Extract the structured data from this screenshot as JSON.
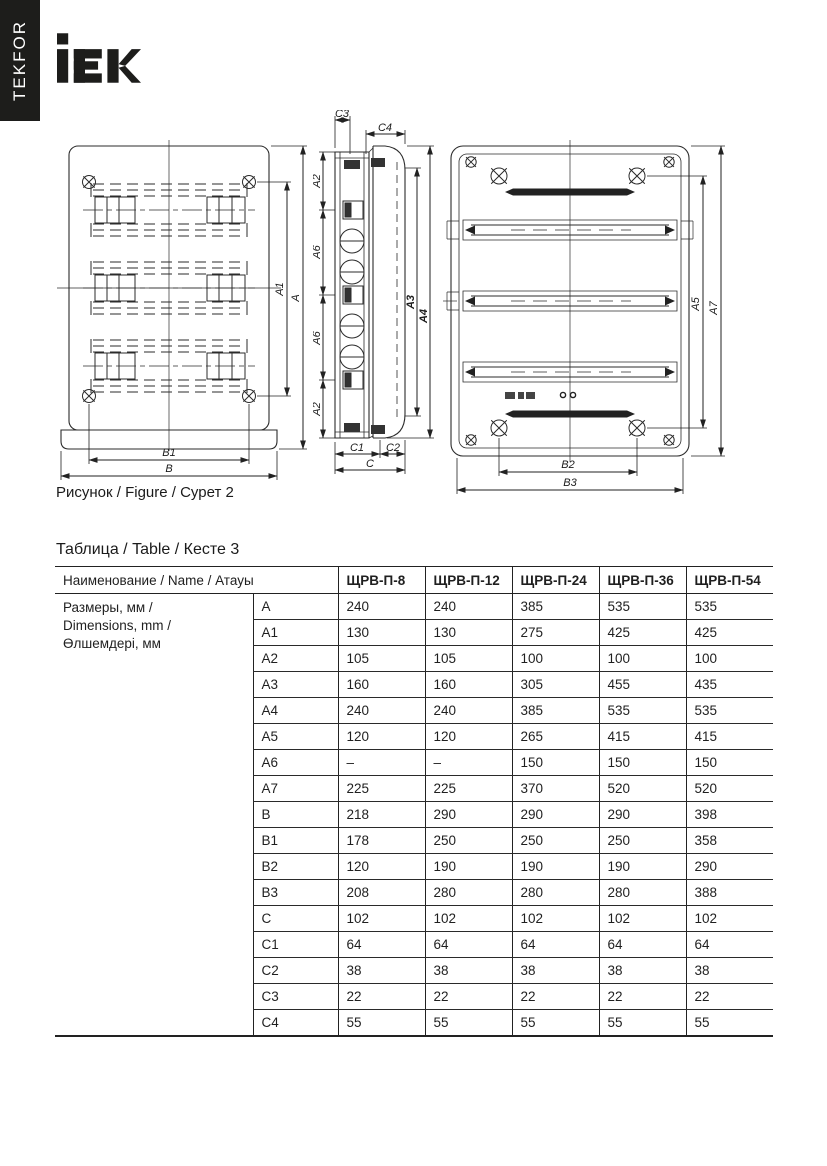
{
  "brand": {
    "vertical_text": "TEKFOR",
    "logo_text": "iEK",
    "brand_color": "#1d1d1b"
  },
  "figure": {
    "caption": "Рисунок / Figure / Сурет 2",
    "front_view": {
      "dim_labels": {
        "a": "A",
        "a1": "A1",
        "b1": "B1",
        "b": "B"
      }
    },
    "side_view": {
      "dim_labels": {
        "c3": "C3",
        "c4": "C4",
        "a2_top": "A2",
        "a6_upper": "A6",
        "a6_lower": "A6",
        "a2_bottom": "A2",
        "a3": "A3",
        "a4": "A4",
        "c1": "C1",
        "c2": "C2",
        "c": "C"
      }
    },
    "back_view": {
      "dim_labels": {
        "a5": "A5",
        "a7": "A7",
        "b2": "B2",
        "b3": "B3"
      }
    }
  },
  "table": {
    "title": "Таблица / Table / Кесте 3",
    "name_header": "Наименование / Name / Атауы",
    "group_label_lines": [
      "Размеры, мм /",
      "Dimensions, mm /",
      "Өлшемдері, мм"
    ],
    "models": [
      "ЩРВ-П-8",
      "ЩРВ-П-12",
      "ЩРВ-П-24",
      "ЩРВ-П-36",
      "ЩРВ-П-54"
    ],
    "rows": [
      {
        "dim": "A",
        "values": [
          "240",
          "240",
          "385",
          "535",
          "535"
        ]
      },
      {
        "dim": "A1",
        "values": [
          "130",
          "130",
          "275",
          "425",
          "425"
        ]
      },
      {
        "dim": "A2",
        "values": [
          "105",
          "105",
          "100",
          "100",
          "100"
        ]
      },
      {
        "dim": "A3",
        "values": [
          "160",
          "160",
          "305",
          "455",
          "435"
        ]
      },
      {
        "dim": "A4",
        "values": [
          "240",
          "240",
          "385",
          "535",
          "535"
        ]
      },
      {
        "dim": "A5",
        "values": [
          "120",
          "120",
          "265",
          "415",
          "415"
        ]
      },
      {
        "dim": "A6",
        "values": [
          "–",
          "–",
          "150",
          "150",
          "150"
        ]
      },
      {
        "dim": "A7",
        "values": [
          "225",
          "225",
          "370",
          "520",
          "520"
        ]
      },
      {
        "dim": "B",
        "values": [
          "218",
          "290",
          "290",
          "290",
          "398"
        ]
      },
      {
        "dim": "B1",
        "values": [
          "178",
          "250",
          "250",
          "250",
          "358"
        ]
      },
      {
        "dim": "B2",
        "values": [
          "120",
          "190",
          "190",
          "190",
          "290"
        ]
      },
      {
        "dim": "B3",
        "values": [
          "208",
          "280",
          "280",
          "280",
          "388"
        ]
      },
      {
        "dim": "C",
        "values": [
          "102",
          "102",
          "102",
          "102",
          "102"
        ]
      },
      {
        "dim": "C1",
        "values": [
          "64",
          "64",
          "64",
          "64",
          "64"
        ]
      },
      {
        "dim": "C2",
        "values": [
          "38",
          "38",
          "38",
          "38",
          "38"
        ]
      },
      {
        "dim": "C3",
        "values": [
          "22",
          "22",
          "22",
          "22",
          "22"
        ]
      },
      {
        "dim": "C4",
        "values": [
          "55",
          "55",
          "55",
          "55",
          "55"
        ]
      }
    ]
  }
}
